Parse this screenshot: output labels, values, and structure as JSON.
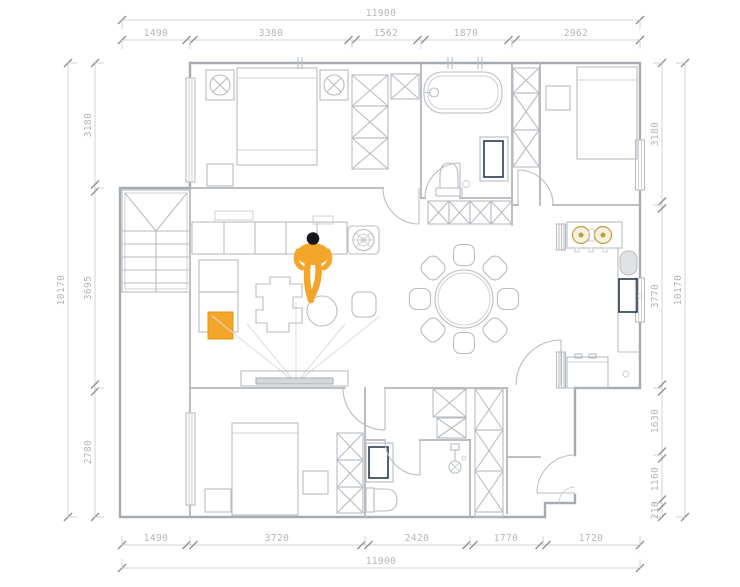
{
  "dimensions": {
    "top": {
      "total": "11900",
      "segments": [
        "1490",
        "3380",
        "1562",
        "1870",
        "2962"
      ]
    },
    "bottom": {
      "total": "11900",
      "segments": [
        "1490",
        "3720",
        "2420",
        "1770",
        "1720"
      ]
    },
    "left": {
      "total": "10170",
      "segments": [
        "3180",
        "3695",
        "2780"
      ]
    },
    "right": {
      "total": "10170",
      "segments": [
        "3180",
        "3770",
        "1630",
        "1160",
        "210"
      ]
    }
  },
  "colors": {
    "accent_orange": "#F4A62A",
    "fixture_blue": "#A9D4EA",
    "line_gray": "#B6BABF"
  }
}
